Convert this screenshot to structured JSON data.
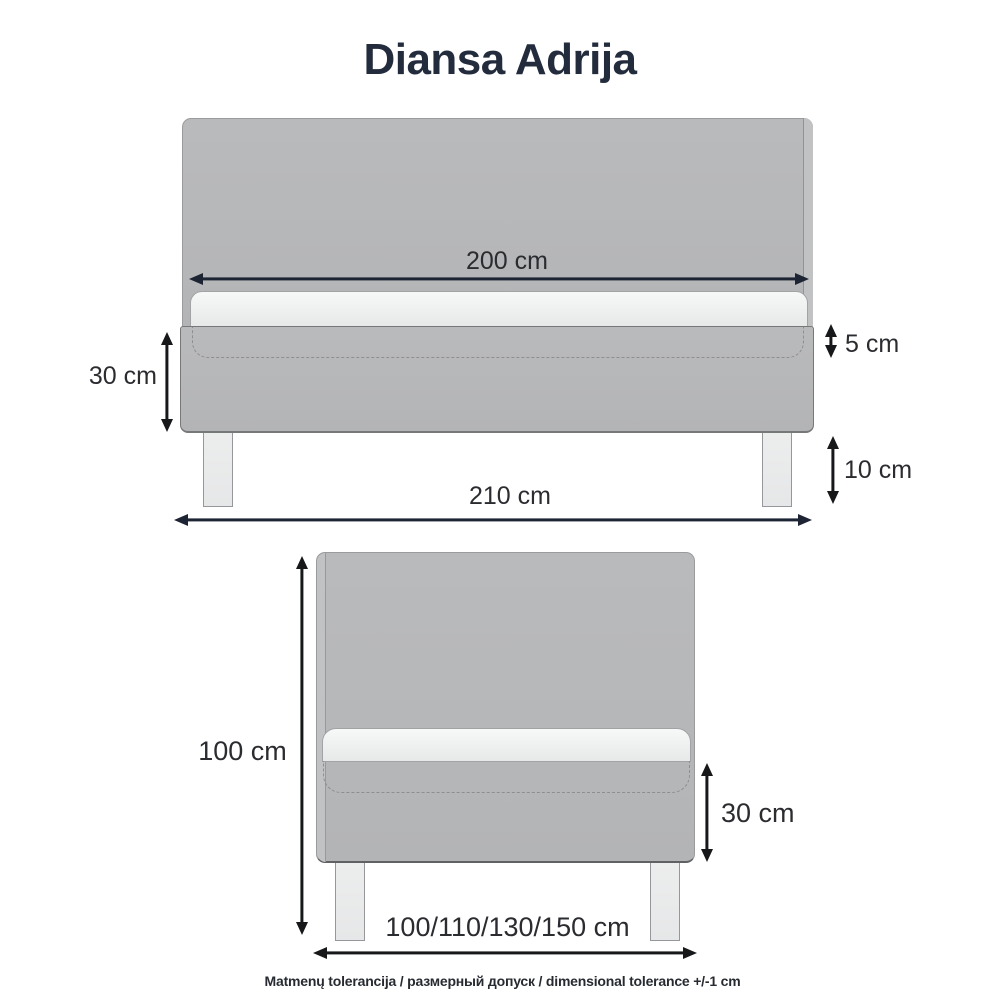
{
  "title": "Diansa Adrija",
  "side_view": {
    "labels": {
      "mattress_length": "200 cm",
      "base_height": "30 cm",
      "topper_thickness": "5 cm",
      "leg_height": "10 cm",
      "total_length": "210 cm"
    }
  },
  "front_view": {
    "labels": {
      "total_height": "100 cm",
      "base_height": "30 cm",
      "width_options": "100/110/130/150 cm"
    }
  },
  "tolerance_note": "Matmenų tolerancija / размерный допуск / dimensional tolerance +/-1 cm",
  "colors": {
    "title_color": "#232c3d",
    "label_color": "#2b2c30",
    "arrow_h_color": "#1d2433",
    "arrow_v_color": "#17181a",
    "bed_fill": "#b7b8ba",
    "bed_fill_light": "#c1c2c4",
    "bed_edge": "#9a9b9d",
    "mattress_fill": "#f5f6f6",
    "leg_fill": "#eaebec",
    "dash_color": "#8d8e90",
    "note_color": "#272b31",
    "bg": "#ffffff"
  }
}
